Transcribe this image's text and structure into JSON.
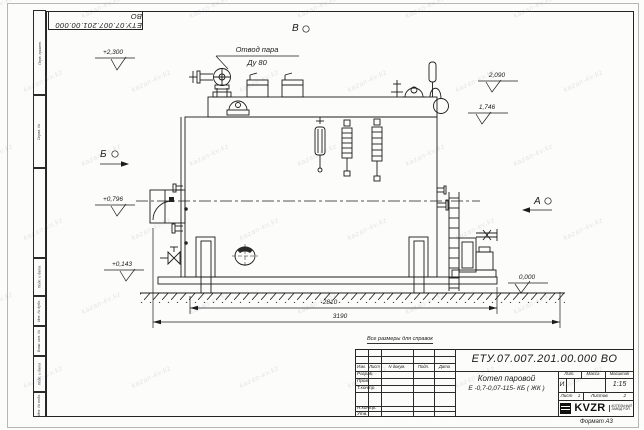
{
  "sheet": {
    "watermark_text": "kazan-kv.kz",
    "format_note": "Формат А3",
    "reference_note": "Все размеры для справок",
    "top_stamp_number": "ЕТУ.07.007.201.00.000  ВО"
  },
  "side_stamp": {
    "labels": [
      "Перв. примен.",
      "Справ. №",
      "",
      "Подп. и дата",
      "Инв. № дубл.",
      "Взам. инв. №",
      "Подп. и дата",
      "Инв. № подл."
    ]
  },
  "drawing": {
    "callout": {
      "line1": "Отвод пара",
      "line2": "Ду 80"
    },
    "views": {
      "v": "В",
      "b": "Б",
      "a": "А"
    },
    "elevations": {
      "e1": "+2,300",
      "e2": "+0,796",
      "e3": "+0,143",
      "e4": "2,090",
      "e5": "1,746",
      "e6": "0,000"
    },
    "dimensions": {
      "d1": "2810",
      "d2": "3190"
    }
  },
  "title_block": {
    "doc_number": "ЕТУ.07.007.201.00.000  ВО",
    "name_line1": "Котел паровой",
    "name_line2": "Е -0,7-0,07-115- КБ ( ЖК )",
    "col_izm": "Изм.",
    "col_list": "Лист",
    "col_ndokum": "N докум.",
    "col_podp": "Подп.",
    "col_data": "Дата",
    "row_razrab": "Разраб.",
    "row_prov": "Пров.",
    "row_tkontr": "Т.контр.",
    "row_nkontr": "Н.контр.",
    "row_utv": "Утв.",
    "lit_header": "Лит.",
    "mass_header": "Масса",
    "scale_header": "Масштаб",
    "lit_value": "И",
    "scale_value": "1:15",
    "sheet_label": "Лист",
    "sheet_value": "1",
    "sheets_label": "Листов",
    "sheets_value": "2",
    "logo_text": "KVZR",
    "logo_sub_line1": "КОТЕЛЬНЫЙ",
    "logo_sub_line2": "ЗАВОД РЭП"
  }
}
